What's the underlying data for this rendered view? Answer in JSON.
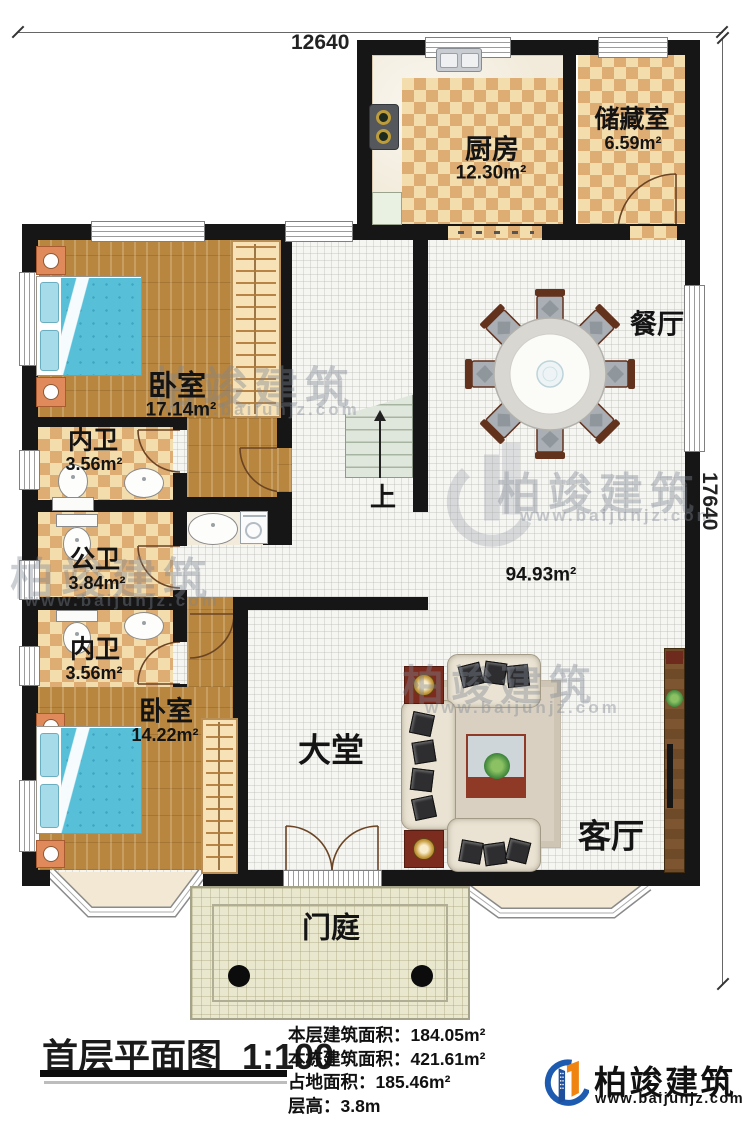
{
  "plan": {
    "dimensions": {
      "top": "12640",
      "right": "17640"
    },
    "rooms": {
      "kitchen": {
        "name": "厨房",
        "area": "12.30m²"
      },
      "storage": {
        "name": "储藏室",
        "area": "6.59m²"
      },
      "dining": {
        "name": "餐厅"
      },
      "bedroom1": {
        "name": "卧室",
        "area": "17.14m²"
      },
      "bath1": {
        "name": "内卫",
        "area": "3.56m²"
      },
      "bath2": {
        "name": "公卫",
        "area": "3.84m²"
      },
      "bath3": {
        "name": "内卫",
        "area": "3.56m²"
      },
      "bedroom2": {
        "name": "卧室",
        "area": "14.22m²"
      },
      "hall": {
        "name": "大堂"
      },
      "living": {
        "name": "客厅"
      },
      "porch": {
        "name": "门庭"
      },
      "open_area": {
        "area": "94.93m²"
      },
      "stairs": {
        "label": "上"
      }
    },
    "title": {
      "text": "首层平面图",
      "scale": "1:100"
    },
    "stats": [
      {
        "label": "本层建筑面积：",
        "value": "184.05m²"
      },
      {
        "label": "本栋建筑面积：",
        "value": "421.61m²"
      },
      {
        "label": "占地面积：",
        "value": "185.46m²"
      },
      {
        "label": "层高：",
        "value": "3.8m"
      }
    ],
    "brand": {
      "name": "柏竣建筑",
      "url": "www.baijunjz.com"
    },
    "watermark": {
      "text": "柏竣建筑",
      "url": "www.baijunjz.com"
    }
  }
}
